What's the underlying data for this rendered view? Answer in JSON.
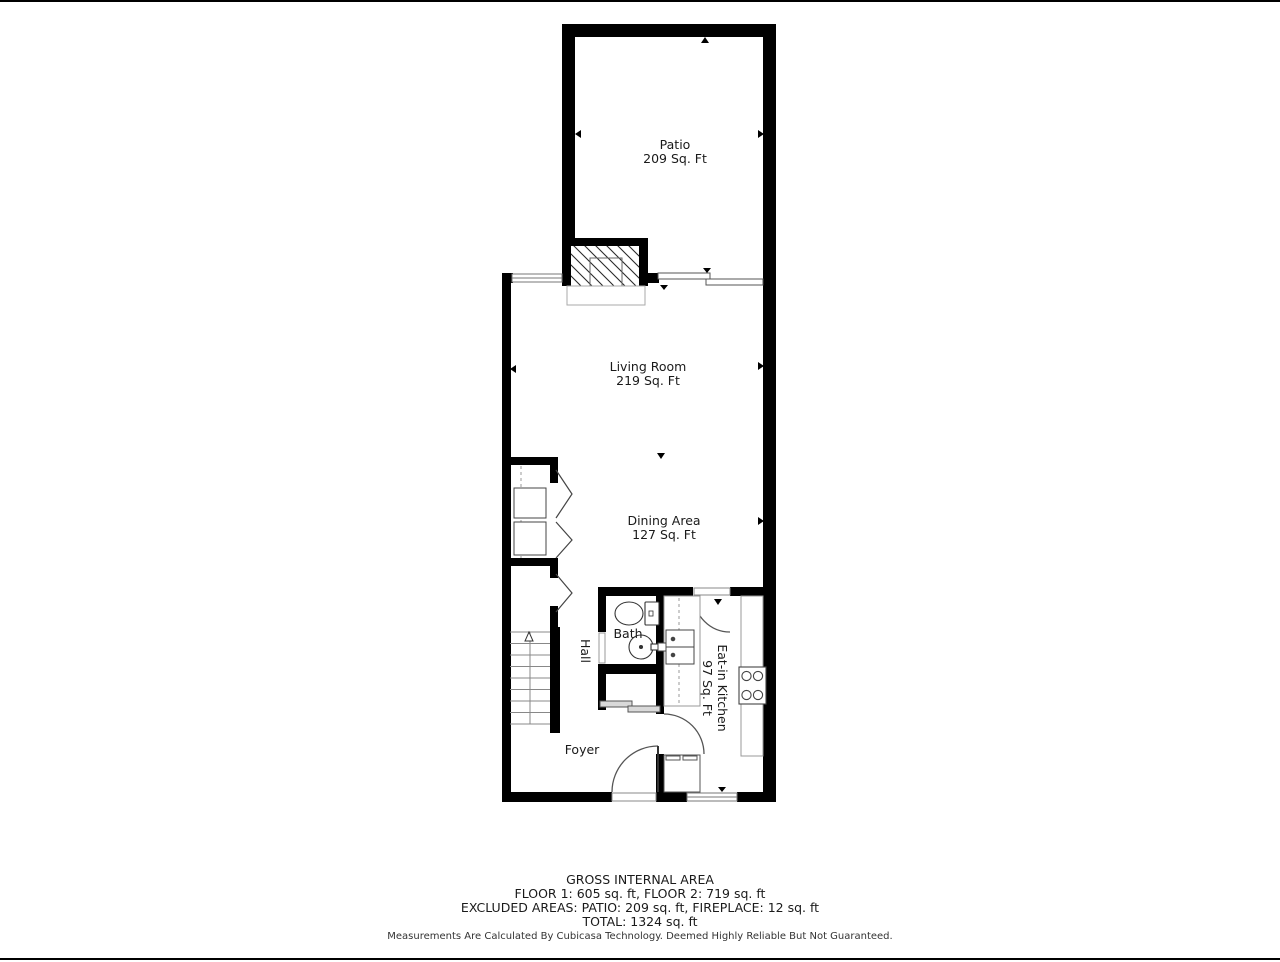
{
  "plan": {
    "rooms": {
      "patio": {
        "name": "Patio",
        "area": "209 Sq. Ft"
      },
      "living": {
        "name": "Living Room",
        "area": "219 Sq. Ft"
      },
      "dining": {
        "name": "Dining Area",
        "area": "127 Sq. Ft"
      },
      "bath": {
        "name": "Bath"
      },
      "hall": {
        "name": "Hall"
      },
      "kitchen": {
        "name": "Eat-in Kitchen",
        "area": "97 Sq. Ft"
      },
      "foyer": {
        "name": "Foyer"
      }
    },
    "colors": {
      "wall": "#000000",
      "fixture": "#444444",
      "light": "#999999"
    }
  },
  "footer": {
    "title": "GROSS INTERNAL AREA",
    "line1": "FLOOR 1: 605 sq. ft, FLOOR 2: 719 sq. ft",
    "line2": "EXCLUDED AREAS: PATIO: 209 sq. ft, FIREPLACE: 12 sq. ft",
    "line3": "TOTAL: 1324 sq. ft",
    "disclaimer": "Measurements Are Calculated By Cubicasa Technology. Deemed Highly Reliable But Not Guaranteed."
  }
}
